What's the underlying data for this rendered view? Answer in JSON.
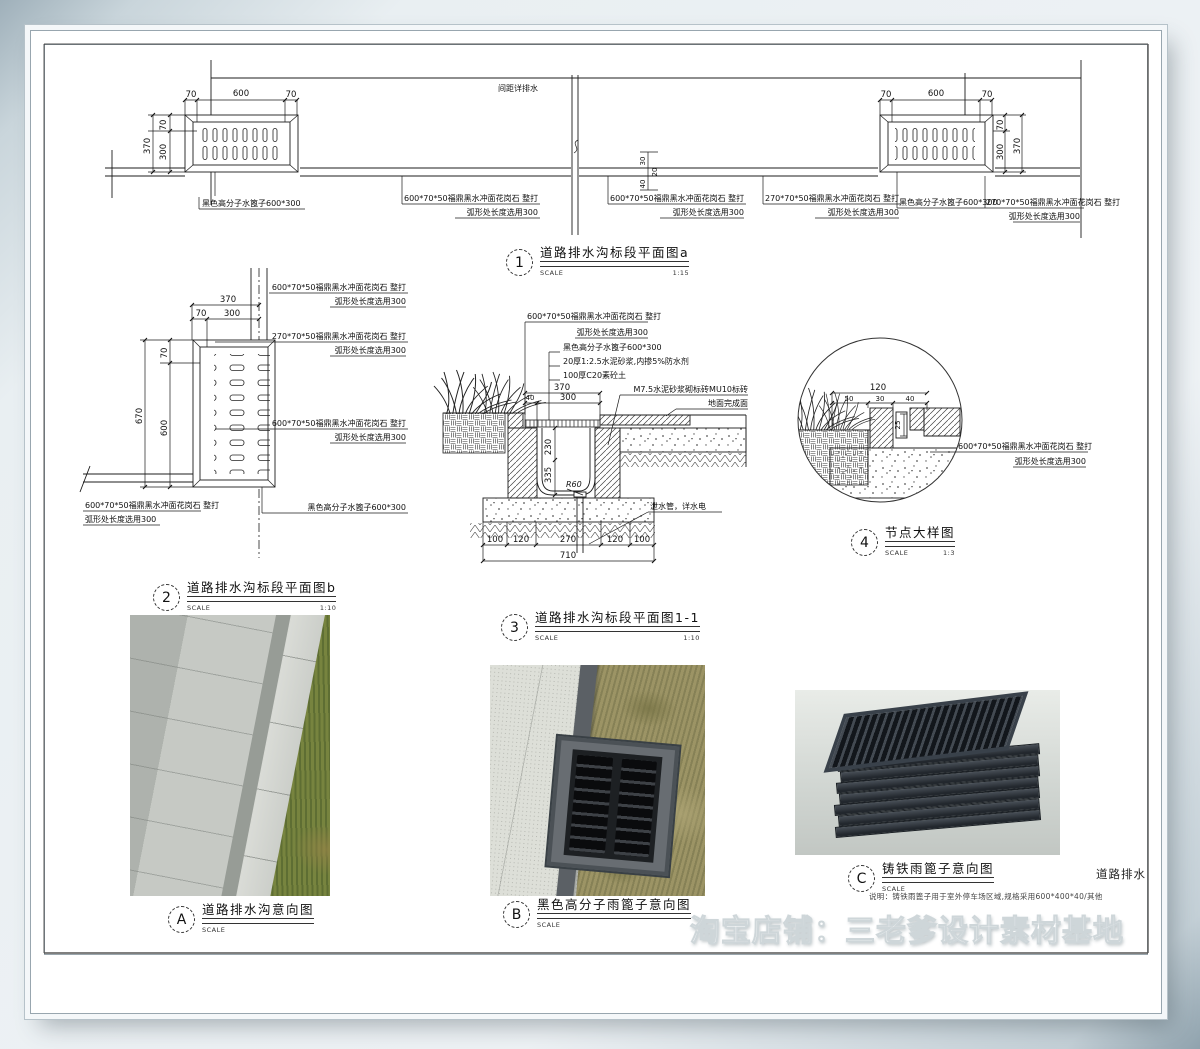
{
  "page": {
    "edge_text": "道路排水",
    "watermark": "淘宝店铺：三老爹设计素材基地"
  },
  "labels": {
    "stone600": "600*70*50福鼎黑水冲面花岗石  整打",
    "stone270": "270*70*50福鼎黑水冲面花岗石  整打",
    "arc300": "弧形处长度选用300",
    "grate": "黑色高分子水篦子600*300",
    "spacing": "间距详排水",
    "mortar": "20厚1:2.5水泥砂浆,内掺5%防水剂",
    "conc": "100厚C20素砼土",
    "brick": "M7.5水泥砂浆砌标砖MU10标砖",
    "ground": "地面完成面",
    "pipe": "泄水管，详水电"
  },
  "dims": {
    "d20": "20",
    "d25": "25",
    "d30": "30",
    "d40": "40",
    "d50": "50",
    "d70": "70",
    "d100": "100",
    "d120": "120",
    "d230": "230",
    "d270": "270",
    "d300": "300",
    "d335": "335",
    "d370": "370",
    "d600": "600",
    "d670": "670",
    "d710": "710",
    "r60": "R60"
  },
  "captions": {
    "scale_label": "SCALE",
    "c1": {
      "num": "1",
      "title": "道路排水沟标段平面图a",
      "scale": "1:15"
    },
    "c2": {
      "num": "2",
      "title": "道路排水沟标段平面图b",
      "scale": "1:10"
    },
    "c3": {
      "num": "3",
      "title": "道路排水沟标段平面图1-1",
      "scale": "1:10"
    },
    "c4": {
      "num": "4",
      "title": "节点大样图",
      "scale": "1:3"
    },
    "cA": {
      "num": "A",
      "title": "道路排水沟意向图",
      "scale": ""
    },
    "cB": {
      "num": "B",
      "title": "黑色高分子雨篦子意向图",
      "scale": ""
    },
    "cC": {
      "num": "C",
      "title": "铸铁雨篦子意向图",
      "scale": "",
      "note": "说明：铸铁雨篦子用于室外停车场区域,规格采用600*400*40/其他"
    }
  }
}
